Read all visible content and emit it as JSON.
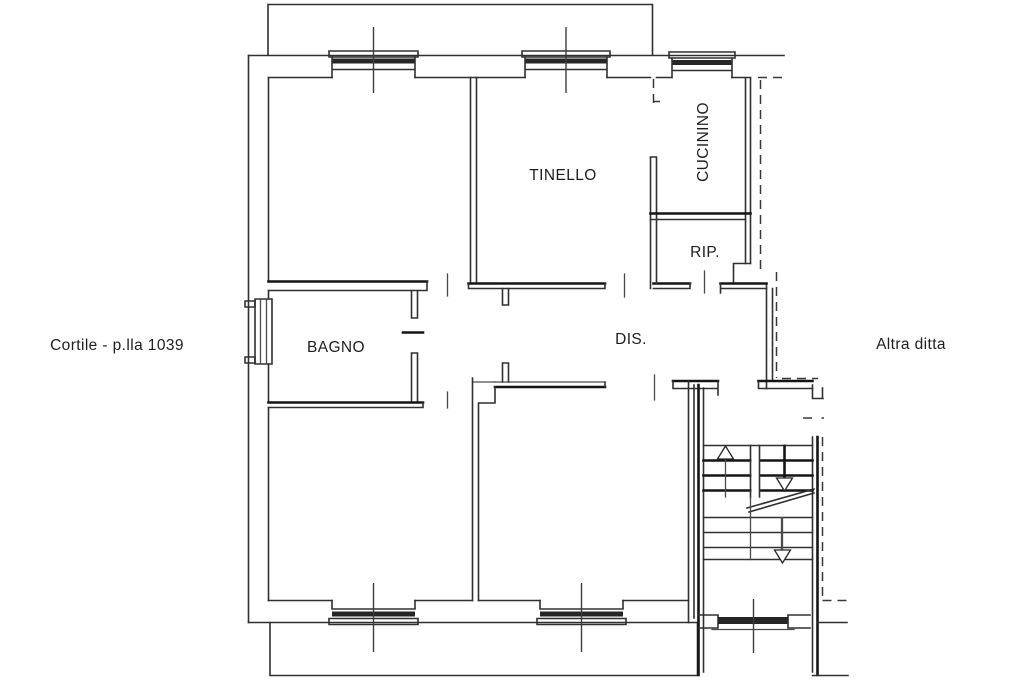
{
  "plan": {
    "background": "#ffffff",
    "ink": "#262626",
    "rooms": [
      {
        "id": "tinello",
        "label": "TINELLO"
      },
      {
        "id": "cucinino",
        "label": "CUCININO"
      },
      {
        "id": "rip",
        "label": "RIP."
      },
      {
        "id": "bagno",
        "label": "BAGNO"
      },
      {
        "id": "dis",
        "label": "DIS."
      }
    ],
    "annotations": [
      {
        "id": "cortile",
        "label": "Cortile - p.lla 1039"
      },
      {
        "id": "altra-ditta",
        "label": "Altra ditta"
      }
    ]
  }
}
